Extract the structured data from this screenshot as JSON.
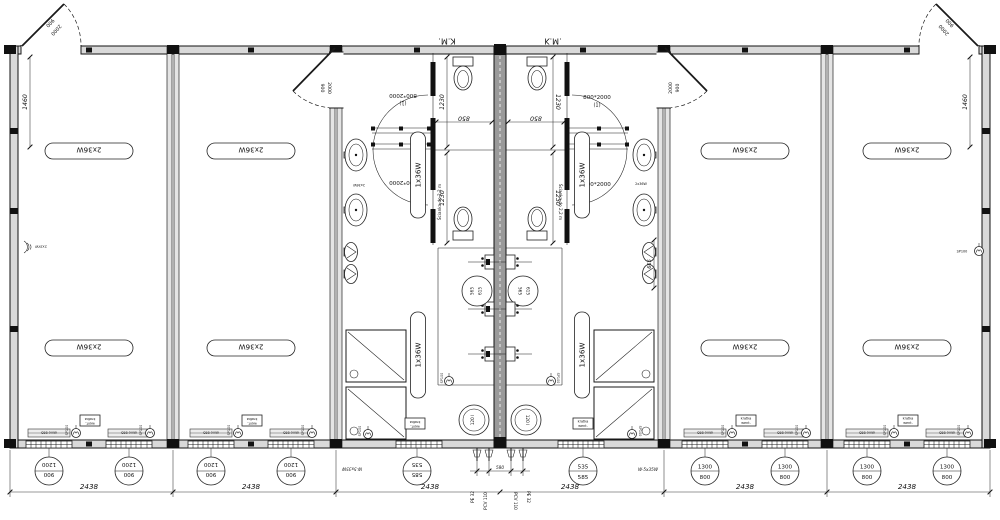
{
  "plan": {
    "km_label": "K.M.",
    "partition_note": "Ścianka do 2,2 m",
    "office_light": "2x36W",
    "sanitary_light": "1x36W",
    "basin_light": "2x36W",
    "fan": "SP100",
    "heater": "120 l",
    "window_tag": "okno 865",
    "vent_box_line1": "kratka",
    "vent_box_line2": "went.",
    "wall_device_left": "2x2kW",
    "wall_device_right": "SP100",
    "cable": "W-5x35W",
    "pipe_pe": "PE 32",
    "pipe_pcv": "PCV 110"
  },
  "dims": {
    "module_width": "2438",
    "room_1460": "1460",
    "stall_850": "850",
    "stall_1230": "1230",
    "dim_665": "665",
    "pipe_580": "580",
    "ext_door_w": "900",
    "ext_door_h": "2000",
    "int_door": "800*2000",
    "int_door_mark_1": "(1)",
    "int_door_mark_d": "(d)",
    "basin_565": "565",
    "basin_615": "615"
  },
  "window_markers": {
    "office_left": {
      "top": "1200",
      "bottom": "900"
    },
    "office_right": {
      "top": "1300",
      "bottom": "800"
    },
    "sanitary": {
      "top": "535",
      "bottom": "585"
    }
  }
}
